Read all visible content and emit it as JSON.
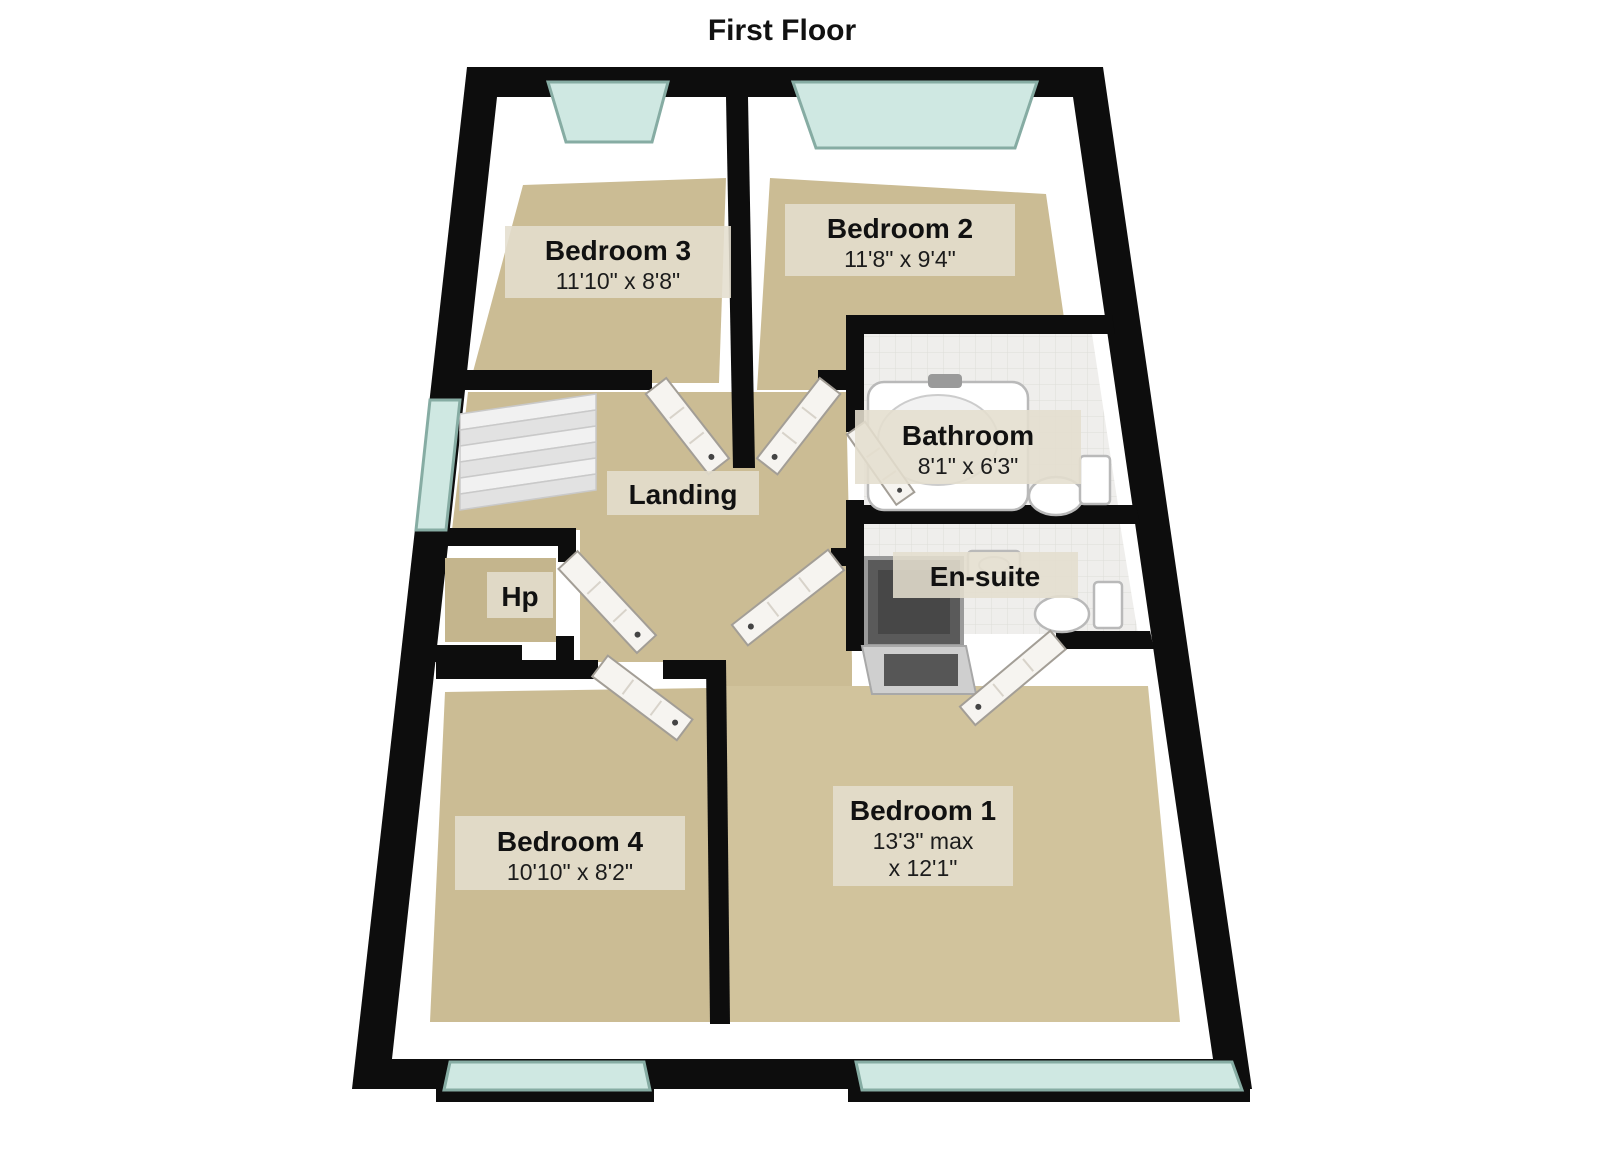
{
  "title": "First Floor",
  "rooms": [
    {
      "name": "Bedroom 3",
      "dims": "11'10\" x 8'8\""
    },
    {
      "name": "Bedroom 2",
      "dims": "11'8\" x 9'4\""
    },
    {
      "name": "Bathroom",
      "dims": "8'1\" x 6'3\""
    },
    {
      "name": "En-suite"
    },
    {
      "name": "Landing"
    },
    {
      "name": "Hp"
    },
    {
      "name": "Bedroom 4",
      "dims": "10'10\" x 8'2\""
    },
    {
      "name": "Bedroom 1",
      "dims": "13'3\" max",
      "dims2": "x 12'1\""
    }
  ],
  "colors": {
    "wall": "#0d0d0d",
    "floor": "#cbbc94",
    "tile": "#efeeec",
    "window_glass": "#cfe8e2",
    "label_background": "#e4decf",
    "text": "#111111",
    "background": "#ffffff"
  }
}
